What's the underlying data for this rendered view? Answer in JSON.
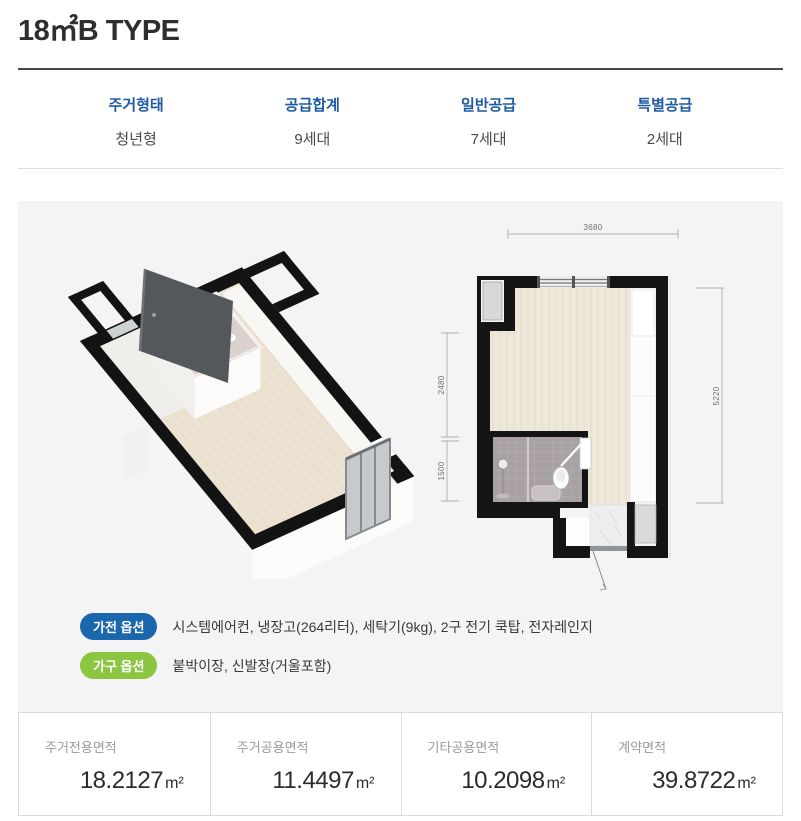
{
  "page": {
    "title": "18㎡B TYPE"
  },
  "summary_table": {
    "columns": [
      {
        "label": "주거형태",
        "value": "청년형"
      },
      {
        "label": "공급합계",
        "value": "9세대"
      },
      {
        "label": "일반공급",
        "value": "7세대"
      },
      {
        "label": "특별공급",
        "value": "2세대"
      }
    ]
  },
  "floorplan": {
    "dim_top": "3680",
    "dim_left_upper": "2480",
    "dim_left_lower": "1500",
    "dim_right": "5220"
  },
  "options": [
    {
      "badge": "가전 옵션",
      "items": "시스템에어컨, 냉장고(264리터), 세탁기(9kg), 2구 전기 쿡탑, 전자레인지"
    },
    {
      "badge": "가구 옵션",
      "items": "붙박이장, 신발장(거울포함)"
    }
  ],
  "area_cards": [
    {
      "label": "주거전용면적",
      "value": "18.2127",
      "unit": "m²"
    },
    {
      "label": "주거공용면적",
      "value": "11.4497",
      "unit": "m²"
    },
    {
      "label": "기타공용면적",
      "value": "10.2098",
      "unit": "m²"
    },
    {
      "label": "계약면적",
      "value": "39.8722",
      "unit": "m²"
    }
  ],
  "colors": {
    "header_blue": "#1f5aa0",
    "badge_blue": "#1a67ad",
    "badge_green": "#8cc540",
    "panel_gray": "#f4f4f4",
    "wall_black": "#141414",
    "wood_floor": "#efe8da"
  }
}
